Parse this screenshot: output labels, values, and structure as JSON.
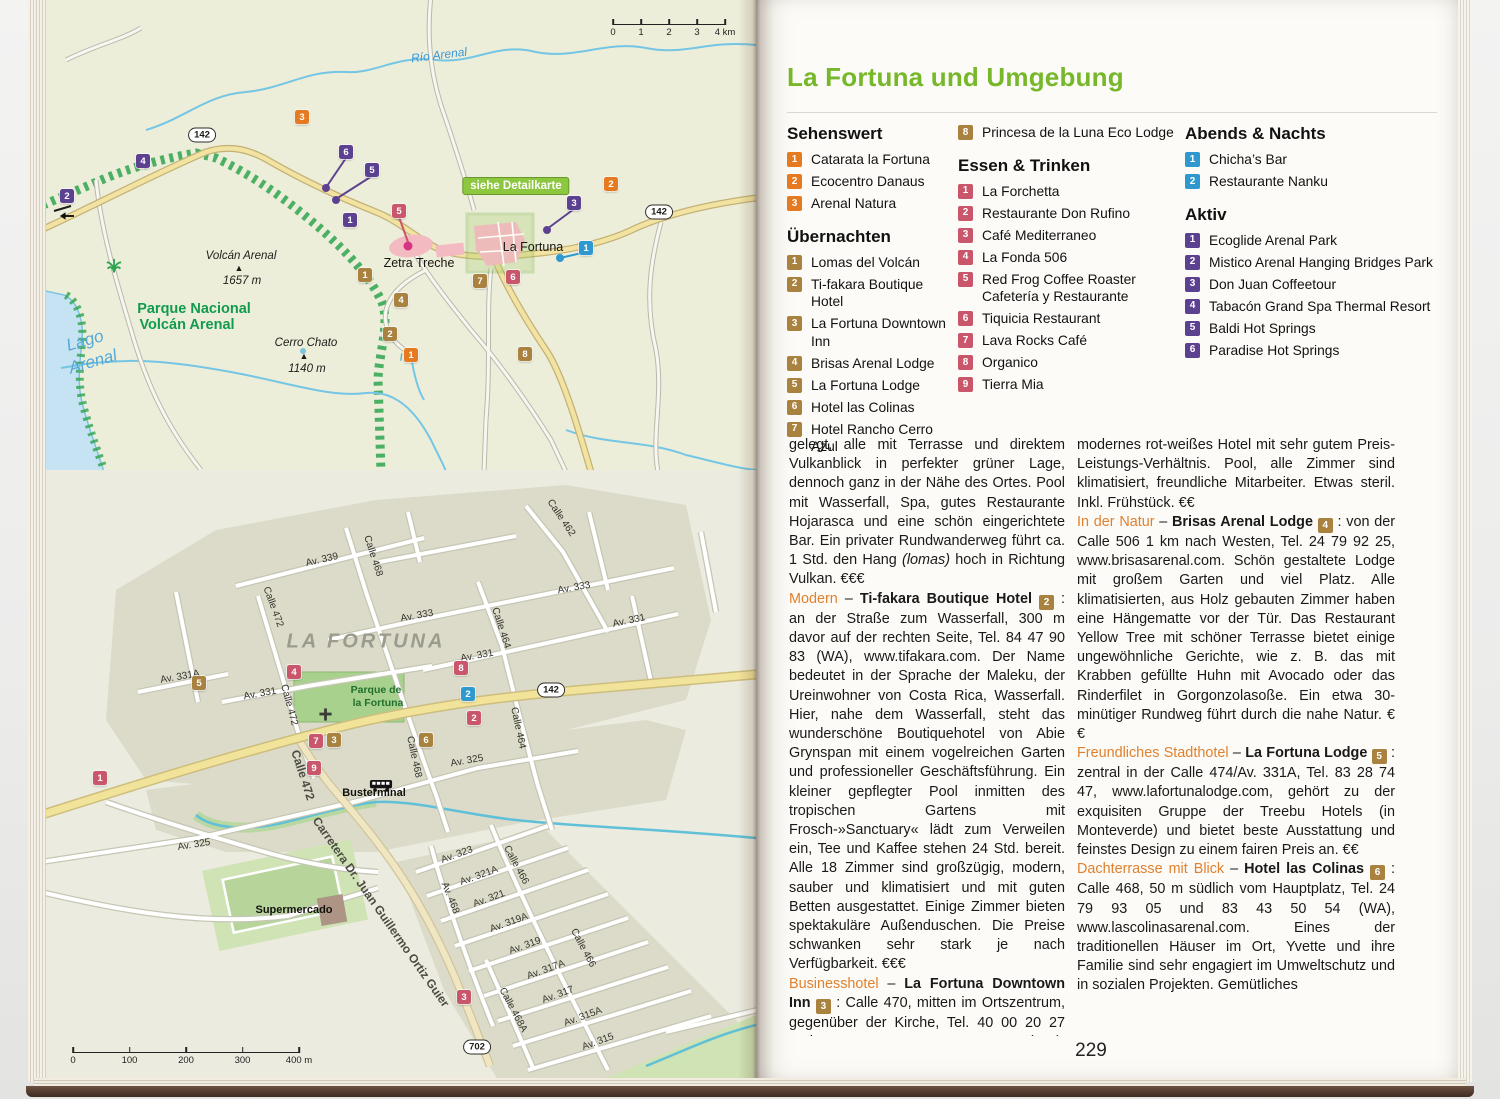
{
  "page_title": "La Fortuna und Umgebung",
  "page_number": "229",
  "legend": {
    "columns": [
      {
        "sections": [
          {
            "title": "Sehenswert",
            "type": "sight",
            "items": [
              {
                "n": "1",
                "label": "Catarata la Fortuna"
              },
              {
                "n": "2",
                "label": "Ecocentro Danaus"
              },
              {
                "n": "3",
                "label": "Arenal Natura"
              }
            ]
          },
          {
            "title": "Übernachten",
            "type": "lodging",
            "items": [
              {
                "n": "1",
                "label": "Lomas del Volcán"
              },
              {
                "n": "2",
                "label": "Ti-fakara Boutique Hotel"
              },
              {
                "n": "3",
                "label": "La Fortuna Downtown Inn"
              },
              {
                "n": "4",
                "label": "Brisas Arenal Lodge"
              },
              {
                "n": "5",
                "label": "La Fortuna Lodge"
              },
              {
                "n": "6",
                "label": "Hotel las Colinas"
              },
              {
                "n": "7",
                "label": "Hotel Rancho Cerro Azul"
              }
            ]
          }
        ]
      },
      {
        "sections": [
          {
            "title": "",
            "type": "lodging",
            "items": [
              {
                "n": "8",
                "label": "Princesa de la Luna Eco Lodge"
              }
            ]
          },
          {
            "title": "Essen & Trinken",
            "type": "food",
            "items": [
              {
                "n": "1",
                "label": "La Forchetta"
              },
              {
                "n": "2",
                "label": "Restaurante Don Rufino"
              },
              {
                "n": "3",
                "label": "Café Mediterraneo"
              },
              {
                "n": "4",
                "label": "La Fonda 506"
              },
              {
                "n": "5",
                "label": "Red Frog Coffee Roaster Cafetería y Restaurante"
              },
              {
                "n": "6",
                "label": "Tiquicia Restaurant"
              },
              {
                "n": "7",
                "label": "Lava Rocks Café"
              },
              {
                "n": "8",
                "label": "Organico"
              },
              {
                "n": "9",
                "label": "Tierra Mia"
              }
            ]
          }
        ]
      },
      {
        "sections": [
          {
            "title": "Abends & Nachts",
            "type": "night",
            "items": [
              {
                "n": "1",
                "label": "Chicha’s Bar"
              },
              {
                "n": "2",
                "label": "Restaurante Nanku"
              }
            ]
          },
          {
            "title": "Aktiv",
            "type": "active",
            "items": [
              {
                "n": "1",
                "label": "Ecoglide Arenal Park"
              },
              {
                "n": "2",
                "label": "Mistico Arenal Hanging Bridges Park"
              },
              {
                "n": "3",
                "label": "Don Juan Coffeetour"
              },
              {
                "n": "4",
                "label": "Tabacón Grand Spa Thermal Resort"
              },
              {
                "n": "5",
                "label": "Baldi Hot Springs"
              },
              {
                "n": "6",
                "label": "Paradise Hot Springs"
              }
            ]
          }
        ]
      }
    ]
  },
  "article": {
    "col1": [
      {
        "runs": [
          {
            "t": "gelegt, alle mit Terrasse und direktem Vulkanblick in perfekter grüner Lage, dennoch ganz in der Nähe des Ortes. Pool mit Wasserfall, Spa, gutes Restaurante Hojarasca und eine schön eingerichtete Bar. Ein privater Rundwanderweg führt ca. 1 Std. den Hang "
          },
          {
            "t": "(lomas)",
            "s": "italic"
          },
          {
            "t": " hoch in Richtung Vulkan. €€€"
          }
        ]
      },
      {
        "runs": [
          {
            "t": "Modern",
            "s": "lead"
          },
          {
            "t": " – "
          },
          {
            "t": "Ti-fakara Boutique Hotel ",
            "s": "bold"
          },
          {
            "t": "2",
            "s": "badge"
          },
          {
            "t": " : an der Straße zum Wasserfall, 300 m davor auf der rechten Seite, Tel. 84 47 90 83 (WA), www.tifakara.com. Der Name bedeutet in der Sprache der Maleku, der Ureinwohner von Costa Rica, Wasserfall. Hier, nahe dem Wasserfall, steht das wunderschöne Boutiquehotel von Abie Grynspan mit einem vogelreichen Garten und professioneller Geschäftsführung. Ein kleiner gepflegter Pool inmitten des tropischen Gartens mit Frosch-»Sanctuary« lädt zum Verweilen ein, Tee und Kaffee stehen 24 Std. bereit. Alle 18 Zimmer sind großzügig, modern, sauber und klimatisiert und mit guten Betten ausgestattet. Einige Zimmer bieten spektakuläre Außenduschen. Die Preise schwanken sehr stark je nach Verfügbarkeit. €€€"
          }
        ]
      },
      {
        "runs": [
          {
            "t": "Businesshotel",
            "s": "lead"
          },
          {
            "t": " – "
          },
          {
            "t": "La Fortuna Downtown Inn ",
            "s": "bold"
          },
          {
            "t": "3",
            "s": "badge"
          },
          {
            "t": " : Calle 470, mitten im Ortszentrum, gegenüber der Kirche, Tel. 40 00 20 27 und 85 27 46 77 (WA), www.lafortunadowntown.com. Ein zentral gelegenes, sauberes,"
          }
        ]
      }
    ],
    "col2": [
      {
        "runs": [
          {
            "t": "modernes rot-weißes Hotel mit sehr gutem Preis-Leistungs-Verhältnis. Pool, alle Zimmer sind klimatisiert, freundliche Mitarbeiter. Etwas steril. Inkl. Frühstück. €€"
          }
        ]
      },
      {
        "runs": [
          {
            "t": "In der Natur",
            "s": "lead"
          },
          {
            "t": " – "
          },
          {
            "t": "Brisas Arenal Lodge ",
            "s": "bold"
          },
          {
            "t": "4",
            "s": "badge"
          },
          {
            "t": " : von der Calle 506 1 km nach Westen, Tel. 24 79 92 25, www.brisasarenal.com. Schön gestaltete Lodge mit großem Garten und viel Platz. Alle klimatisierten, aus Holz gebauten Zimmer haben eine Hängematte vor der Tür. Das Restaurant Yellow Tree mit schöner Terrasse bietet einige ungewöhnliche Gerichte, wie z. B. das mit Krabben gefüllte Huhn mit Avocado oder das Rinderfilet in Gorgonzolasoße. Ein etwa 30-minütiger Rundweg führt durch die nahe Natur. €€"
          }
        ]
      },
      {
        "runs": [
          {
            "t": "Freundliches Stadthotel",
            "s": "lead"
          },
          {
            "t": " – "
          },
          {
            "t": "La Fortuna Lodge ",
            "s": "bold"
          },
          {
            "t": "5",
            "s": "badge"
          },
          {
            "t": " : zentral in der Calle 474/Av. 331A, Tel. 83 28 74 47, www.lafortunalodge.com, gehört zu der exquisiten Gruppe der Treebu Hotels (in Monteverde) und bietet beste Ausstattung und feinstes Design zu einem fairen Preis an. €€"
          }
        ]
      },
      {
        "runs": [
          {
            "t": "Dachterrasse mit Blick",
            "s": "lead"
          },
          {
            "t": " – "
          },
          {
            "t": "Hotel las Colinas ",
            "s": "bold"
          },
          {
            "t": "6",
            "s": "badge"
          },
          {
            "t": " : Calle 468, 50 m südlich vom Hauptplatz, Tel. 24 79 93 05 und 83 43 50 54 (WA), www.lascolinasarenal.com. Eines der traditionellen Häuser im Ort, Yvette und ihre Familie sind sehr engagiert im Umweltschutz und in sozialen Projekten. Gemütliches"
          }
        ]
      }
    ]
  },
  "map_overview": {
    "scale": {
      "x": 567,
      "y": 16,
      "w": 112,
      "labels": [
        "0",
        "1",
        "2",
        "3",
        "4 km"
      ]
    },
    "labels": [
      {
        "t": "Río Arenal",
        "x": 393,
        "y": 55,
        "cls": "water",
        "rot": -7
      },
      {
        "t": "142",
        "x": 156,
        "y": 135,
        "cls": "shield"
      },
      {
        "t": "142",
        "x": 613,
        "y": 212,
        "cls": "shield"
      },
      {
        "t": "siehe Detailkarte",
        "x": 470,
        "y": 186,
        "cls": "detailtag"
      },
      {
        "t": "La Fortuna",
        "x": 487,
        "y": 247,
        "cls": "town"
      },
      {
        "t": "Zetra Treche",
        "x": 373,
        "y": 263,
        "cls": "town"
      },
      {
        "t": "Volcán Arenal",
        "x": 195,
        "y": 256,
        "cls": "peakname"
      },
      {
        "t": "▲",
        "x": 193,
        "y": 268,
        "cls": "peaktri"
      },
      {
        "t": "1657 m",
        "x": 196,
        "y": 281,
        "cls": "peakname"
      },
      {
        "t": "Parque Nacional",
        "x": 148,
        "y": 309,
        "cls": "park"
      },
      {
        "t": "Volcán Arenal",
        "x": 141,
        "y": 325,
        "cls": "park"
      },
      {
        "t": "Cerro Chato",
        "x": 260,
        "y": 343,
        "cls": "peakname"
      },
      {
        "t": "▲",
        "x": 258,
        "y": 356,
        "cls": "peaktri"
      },
      {
        "t": "1140 m",
        "x": 261,
        "y": 369,
        "cls": "peakname"
      },
      {
        "t": "Lago",
        "x": 39,
        "y": 341,
        "cls": "waterbig",
        "rot": -16
      },
      {
        "t": "Arenal",
        "x": 47,
        "y": 362,
        "cls": "waterbig",
        "rot": -16
      },
      {
        "icon": "palm",
        "x": 59,
        "y": 257
      },
      {
        "icon": "falls",
        "x": 352,
        "y": 351
      },
      {
        "icon": "arrow-left",
        "x": 13,
        "y": 211
      }
    ],
    "markers": [
      {
        "n": "3",
        "type": "sight",
        "x": 256,
        "y": 117
      },
      {
        "n": "6",
        "type": "active",
        "x": 300,
        "y": 152
      },
      {
        "n": "5",
        "type": "active",
        "x": 326,
        "y": 170
      },
      {
        "n": "4",
        "type": "active",
        "x": 97,
        "y": 161
      },
      {
        "n": "2",
        "type": "active",
        "x": 21,
        "y": 196
      },
      {
        "n": "1",
        "type": "active",
        "x": 304,
        "y": 220
      },
      {
        "n": "5",
        "type": "food",
        "x": 353,
        "y": 211
      },
      {
        "n": "2",
        "type": "sight",
        "x": 565,
        "y": 184
      },
      {
        "n": "3",
        "type": "active",
        "x": 528,
        "y": 203
      },
      {
        "n": "1",
        "type": "night",
        "x": 540,
        "y": 248
      },
      {
        "n": "7",
        "type": "lodging",
        "x": 434,
        "y": 281
      },
      {
        "n": "6",
        "type": "food",
        "x": 467,
        "y": 277
      },
      {
        "n": "1",
        "type": "lodging",
        "x": 319,
        "y": 275
      },
      {
        "n": "4",
        "type": "lodging",
        "x": 355,
        "y": 300
      },
      {
        "n": "2",
        "type": "lodging",
        "x": 344,
        "y": 334
      },
      {
        "n": "1",
        "type": "sight",
        "x": 365,
        "y": 355
      },
      {
        "n": "8",
        "type": "lodging",
        "x": 479,
        "y": 354
      }
    ]
  },
  "map_detail": {
    "scale": {
      "x": 27,
      "y": 1044,
      "w": 226,
      "labels": [
        "0",
        "100",
        "200",
        "300",
        "400 m"
      ]
    },
    "labels": [
      {
        "t": "Calle 462",
        "x": 515,
        "y": 518,
        "rot": 56
      },
      {
        "t": "Av. 339",
        "x": 276,
        "y": 560,
        "rot": -13
      },
      {
        "t": "Calle 468",
        "x": 327,
        "y": 556,
        "rot": 72
      },
      {
        "t": "Calle 472",
        "x": 227,
        "y": 607,
        "rot": 70
      },
      {
        "t": "Av. 333",
        "x": 371,
        "y": 616,
        "rot": -10
      },
      {
        "t": "Av. 333",
        "x": 528,
        "y": 588,
        "rot": -10
      },
      {
        "t": "Calle 464",
        "x": 455,
        "y": 628,
        "rot": 72
      },
      {
        "t": "Av. 331",
        "x": 583,
        "y": 621,
        "rot": -12
      },
      {
        "t": "Av. 331",
        "x": 431,
        "y": 656,
        "rot": -10
      },
      {
        "t": "LA FORTUNA",
        "x": 320,
        "y": 642,
        "cls": "cityname"
      },
      {
        "t": "Av. 331A",
        "x": 134,
        "y": 677,
        "rot": -10
      },
      {
        "t": "Av. 331",
        "x": 214,
        "y": 694,
        "rot": -10
      },
      {
        "t": "Calle 472",
        "x": 243,
        "y": 705,
        "rot": 75
      },
      {
        "t": "Parque de",
        "x": 330,
        "y": 690,
        "cls": "parksm"
      },
      {
        "t": "la Fortuna",
        "x": 332,
        "y": 703,
        "cls": "parksm"
      },
      {
        "t": "142",
        "x": 505,
        "y": 690,
        "cls": "shield"
      },
      {
        "t": "Calle 464",
        "x": 472,
        "y": 728,
        "rot": 78
      },
      {
        "t": "Calle 468",
        "x": 368,
        "y": 757,
        "rot": 78
      },
      {
        "t": "Av. 325",
        "x": 421,
        "y": 761,
        "rot": -10
      },
      {
        "t": "Calle 472",
        "x": 257,
        "y": 775,
        "rot": 72,
        "cls": "big"
      },
      {
        "t": "Busterminal",
        "x": 328,
        "y": 793,
        "cls": "poi"
      },
      {
        "t": "Av. 325",
        "x": 148,
        "y": 845,
        "rot": -9
      },
      {
        "t": "Supermercado",
        "x": 248,
        "y": 910,
        "cls": "poi"
      },
      {
        "t": "Carretera Dr. Juan Guillermo Ortiz Guier",
        "x": 335,
        "y": 912,
        "rot": 55,
        "cls": "big"
      },
      {
        "t": "Av. 323",
        "x": 411,
        "y": 855,
        "rot": -20
      },
      {
        "t": "Av. 321A",
        "x": 433,
        "y": 876,
        "rot": -20
      },
      {
        "t": "Calle 466",
        "x": 470,
        "y": 865,
        "rot": 62
      },
      {
        "t": "Av. 468",
        "x": 404,
        "y": 898,
        "rot": 68
      },
      {
        "t": "Av. 321",
        "x": 443,
        "y": 899,
        "rot": -20
      },
      {
        "t": "Av. 319A",
        "x": 463,
        "y": 923,
        "rot": -20
      },
      {
        "t": "Av. 319",
        "x": 479,
        "y": 946,
        "rot": -20
      },
      {
        "t": "Calle 466",
        "x": 537,
        "y": 948,
        "rot": 62
      },
      {
        "t": "Av. 317A",
        "x": 500,
        "y": 970,
        "rot": -20
      },
      {
        "t": "Av. 317",
        "x": 512,
        "y": 995,
        "rot": -20
      },
      {
        "t": "Calle 468A",
        "x": 467,
        "y": 1010,
        "rot": 62
      },
      {
        "t": "Av. 315A",
        "x": 537,
        "y": 1017,
        "rot": -20
      },
      {
        "t": "Av. 315",
        "x": 552,
        "y": 1042,
        "rot": -20
      },
      {
        "t": "702",
        "x": 431,
        "y": 1047,
        "cls": "shield"
      },
      {
        "icon": "church",
        "x": 272,
        "y": 707
      },
      {
        "icon": "bus",
        "x": 323,
        "y": 779
      }
    ],
    "markers": [
      {
        "n": "4",
        "type": "food",
        "x": 248,
        "y": 672
      },
      {
        "n": "8",
        "type": "food",
        "x": 415,
        "y": 668
      },
      {
        "n": "5",
        "type": "lodging",
        "x": 153,
        "y": 683
      },
      {
        "n": "2",
        "type": "night",
        "x": 422,
        "y": 694
      },
      {
        "n": "2",
        "type": "food",
        "x": 428,
        "y": 718
      },
      {
        "n": "7",
        "type": "food",
        "x": 270,
        "y": 741
      },
      {
        "n": "3",
        "type": "lodging",
        "x": 288,
        "y": 740
      },
      {
        "n": "6",
        "type": "lodging",
        "x": 380,
        "y": 740
      },
      {
        "n": "9",
        "type": "food",
        "x": 268,
        "y": 768
      },
      {
        "n": "1",
        "type": "food",
        "x": 54,
        "y": 778
      },
      {
        "n": "3",
        "type": "food",
        "x": 418,
        "y": 997
      }
    ]
  }
}
